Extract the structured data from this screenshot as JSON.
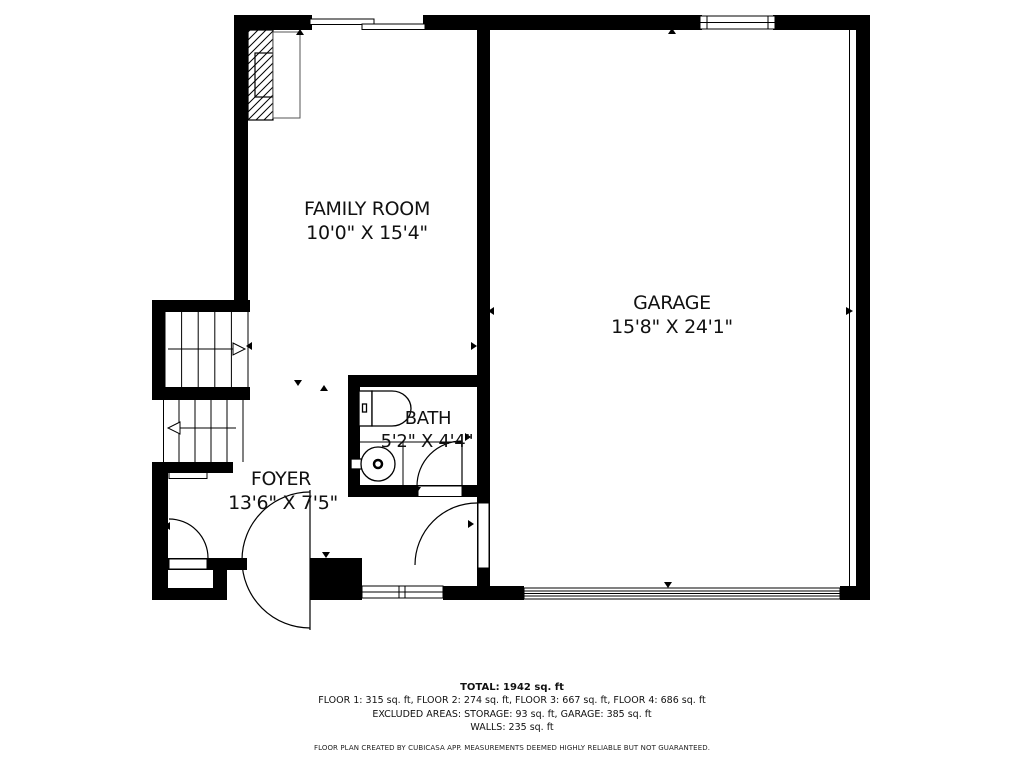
{
  "plan": {
    "rooms": {
      "family_room": {
        "name": "FAMILY ROOM",
        "dimensions": "10'0\" X 15'4\""
      },
      "garage": {
        "name": "GARAGE",
        "dimensions": "15'8\" X 24'1\""
      },
      "bath": {
        "name": "BATH",
        "dimensions": "5'2\" X 4'4\""
      },
      "foyer": {
        "name": "FOYER",
        "dimensions": "13'6\" X 7'5\""
      }
    }
  },
  "summary": {
    "total": "TOTAL: 1942 sq. ft",
    "floors": "FLOOR 1: 315 sq. ft, FLOOR 2: 274 sq. ft, FLOOR 3: 667 sq. ft, FLOOR 4: 686 sq. ft",
    "excluded_areas": "EXCLUDED AREAS: STORAGE: 93 sq. ft, GARAGE: 385 sq. ft",
    "walls": "WALLS: 235 sq. ft"
  },
  "disclaimer": "FLOOR PLAN CREATED BY CUBICASA APP. MEASUREMENTS DEEMED HIGHLY RELIABLE BUT NOT GUARANTEED.",
  "colors": {
    "wall": "#000000",
    "background": "#ffffff",
    "text": "#111111"
  }
}
